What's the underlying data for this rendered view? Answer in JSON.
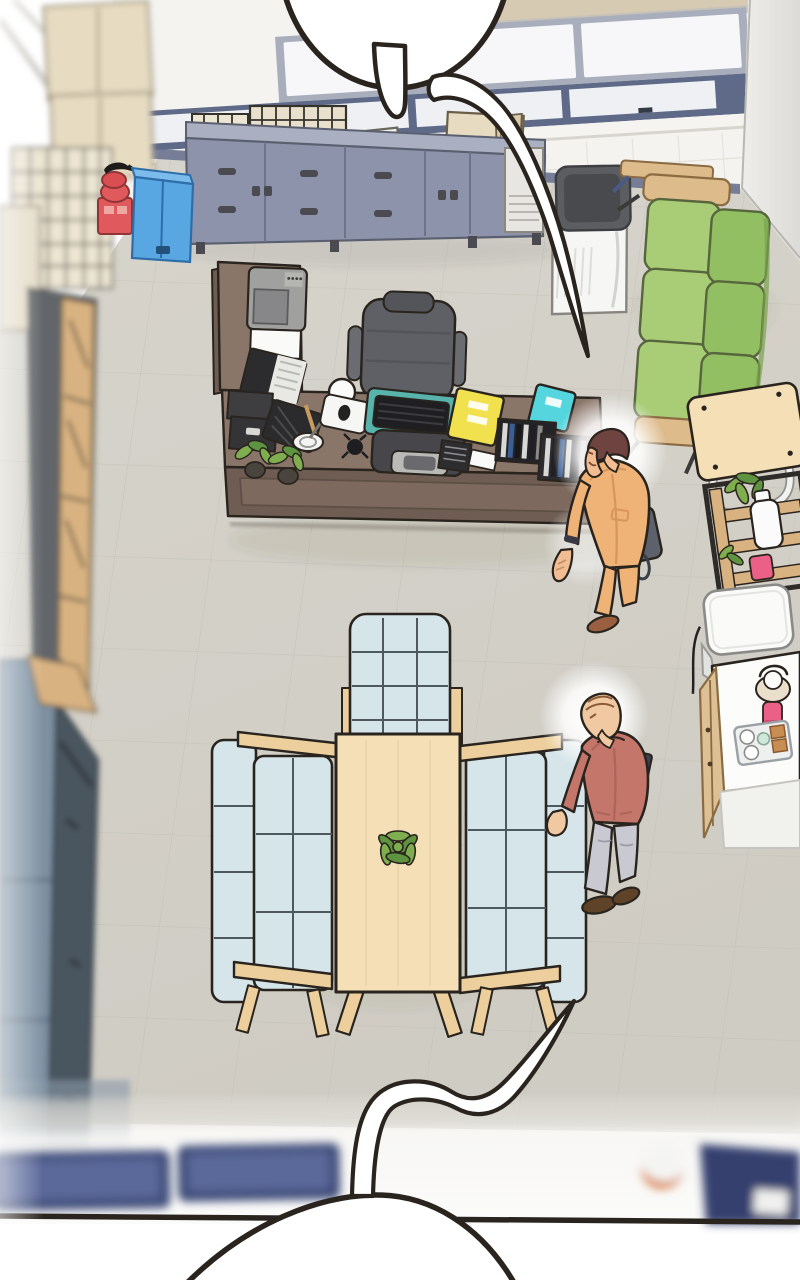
{
  "panel": {
    "type": "webtoon-comic-panel",
    "scene": "Top-down isometric view of an office room with an executive desk area, a meeting settee set, a green sofa lounge corner and a kitchenette; two men stand in the room; cropped speech bubbles at top and bottom",
    "text_visible": false
  },
  "bubbles": {
    "top": {
      "text": ""
    },
    "bottom": {
      "text": ""
    }
  },
  "labels": {
    "panel": "Webtoon panel - top-down office scene",
    "bubble_top": "Speech bubble (cropped, top)",
    "bubble_bottom": "Speech bubble (cropped, bottom)",
    "window_wall": "Window wall with frosted panes",
    "right_wall": "Right wall corner",
    "floor": "Office floor",
    "shelves": "Left storage shelves and cabinets",
    "sideboard": "Blue-gray storage sideboard with paper stacks",
    "extinguisher": "Fire extinguisher on stand",
    "cooler": "Blue cabinet",
    "purifier": "Air purifier",
    "green_sofa": "Green three-seat sofa",
    "folding_table": "Folding wood table",
    "plant_rack": "Plant rack with white bottle",
    "fridge": "Small white appliance",
    "counter": "Kitchenette counter with tray, cups and pink tumbler",
    "desk": "Executive L-shaped desk",
    "chair": "Office chair",
    "meeting": "Meeting table with light-blue settees",
    "man1": "Man in tan suit with shoulder bag",
    "man2": "Balding man in red jacket carrying a folder",
    "band": "Blurred corridor strip at bottom"
  },
  "characters": [
    {
      "id": "man-tan-suit",
      "description": "Standing by the desk, tan suit, brown hair, dark shoulder bag, wrist watch, brown loafers"
    },
    {
      "id": "man-red-jacket",
      "description": "Standing by the right settee, balding, dusty-red jacket, gray trousers, dark brown shoes, dark folder under arm"
    }
  ],
  "objects": [
    "speech bubble (top, cropped)",
    "speech bubble tail ribbon (top)",
    "window wall",
    "storage sideboard",
    "wire document trays",
    "paper stacks",
    "cardboard box",
    "fire extinguisher",
    "blue cabinet",
    "left storage shelves",
    "stacked archive boxes",
    "steel cabinets",
    "air purifier",
    "green sofa",
    "folding side table",
    "plant rack with bottle",
    "white appliance",
    "kitchenette counter",
    "executive desk",
    "office chair",
    "monitor",
    "keyboard on teal desk mat",
    "printer",
    "laptop",
    "desk lamp",
    "potted plants",
    "yellow folder",
    "cyan book",
    "file organizers",
    "meeting table",
    "succulent centerpiece",
    "three light-blue settees",
    "blurred corridor strip",
    "panel border line",
    "speech bubble (bottom, cropped)"
  ],
  "colors": {
    "ink": "#2a241f",
    "bg_white": "#ffffff",
    "floor": "#d3d0c8",
    "floor_line": "#bdbab1",
    "wall_white": "#f4f3f0",
    "wall_shade": "#e9e8e4",
    "window_glass": "#f7f7f9",
    "window_frame": "#a9aebc",
    "window_frame_dark": "#5f6a88",
    "beam_tan": "#d7cab2",
    "baseboard": "#6a7490",
    "sideboard_front": "#8d93aa",
    "sideboard_top": "#aab0c2",
    "paper_white": "#f4f3ee",
    "paper_cream": "#efe6c0",
    "box_cream": "#e7dcc2",
    "wire_dark": "#35322c",
    "cooler_blue": "#58a7e2",
    "extinguisher_red": "#e0595c",
    "purifier_body": "#f6f6f4",
    "purifier_top": "#5b5d61",
    "sofa_green_seat": "#a9cd77",
    "sofa_green_back": "#93bf63",
    "wood_tan": "#ddbb8b",
    "table_wood": "#f4dfb6",
    "rack_wood": "#d9b281",
    "rack_frame": "#2e2c29",
    "bottle_white": "#fbfbfb",
    "pink_item": "#ea6087",
    "appliance_white": "#fafaf8",
    "counter_white": "#fcfcfb",
    "counter_wood": "#ddc094",
    "caramel": "#c78d52",
    "mint": "#cfe8da",
    "desk_top": "#8a7569",
    "desk_front": "#6f5d53",
    "desk_inner": "#7d695e",
    "chair_gray": "#5f6065",
    "chair_dark": "#54555a",
    "mat_teal": "#57b3ac",
    "keyboard_black": "#1f1f22",
    "monitor_gray": "#46464b",
    "stand_silver": "#b9b9b6",
    "folder_yellow": "#f2e14e",
    "book_cyan": "#55d5de",
    "device_black": "#2d2d30",
    "plant_green": "#7fae4f",
    "plant_green_dark": "#5e9440",
    "pot_dark": "#4a443e",
    "meeting_sofa": "#d5e5e9",
    "meeting_sofa_line": "#4d585f",
    "meeting_wood": "#eccf9c",
    "suit_tan": "#efb277",
    "suit_shade": "#d8965a",
    "hair_brown": "#6e4340",
    "skin": "#f2bd92",
    "skin2": "#f0c9a2",
    "bag_gray": "#5d616b",
    "shoe_tan": "#9a5f40",
    "jacket_red": "#c4766a",
    "jacket_red_shade": "#ab655a",
    "pants_gray": "#c9c9d2",
    "shoe_brown": "#5f4328",
    "folder_dark": "#3c4250",
    "hair_sparse": "#8a5a34",
    "blur_navy": "#3e4b78",
    "blur_navy_light": "#5a689a",
    "door_navy": "#35406e",
    "head_orange": "#d9824a",
    "glow": "#ffffff"
  }
}
